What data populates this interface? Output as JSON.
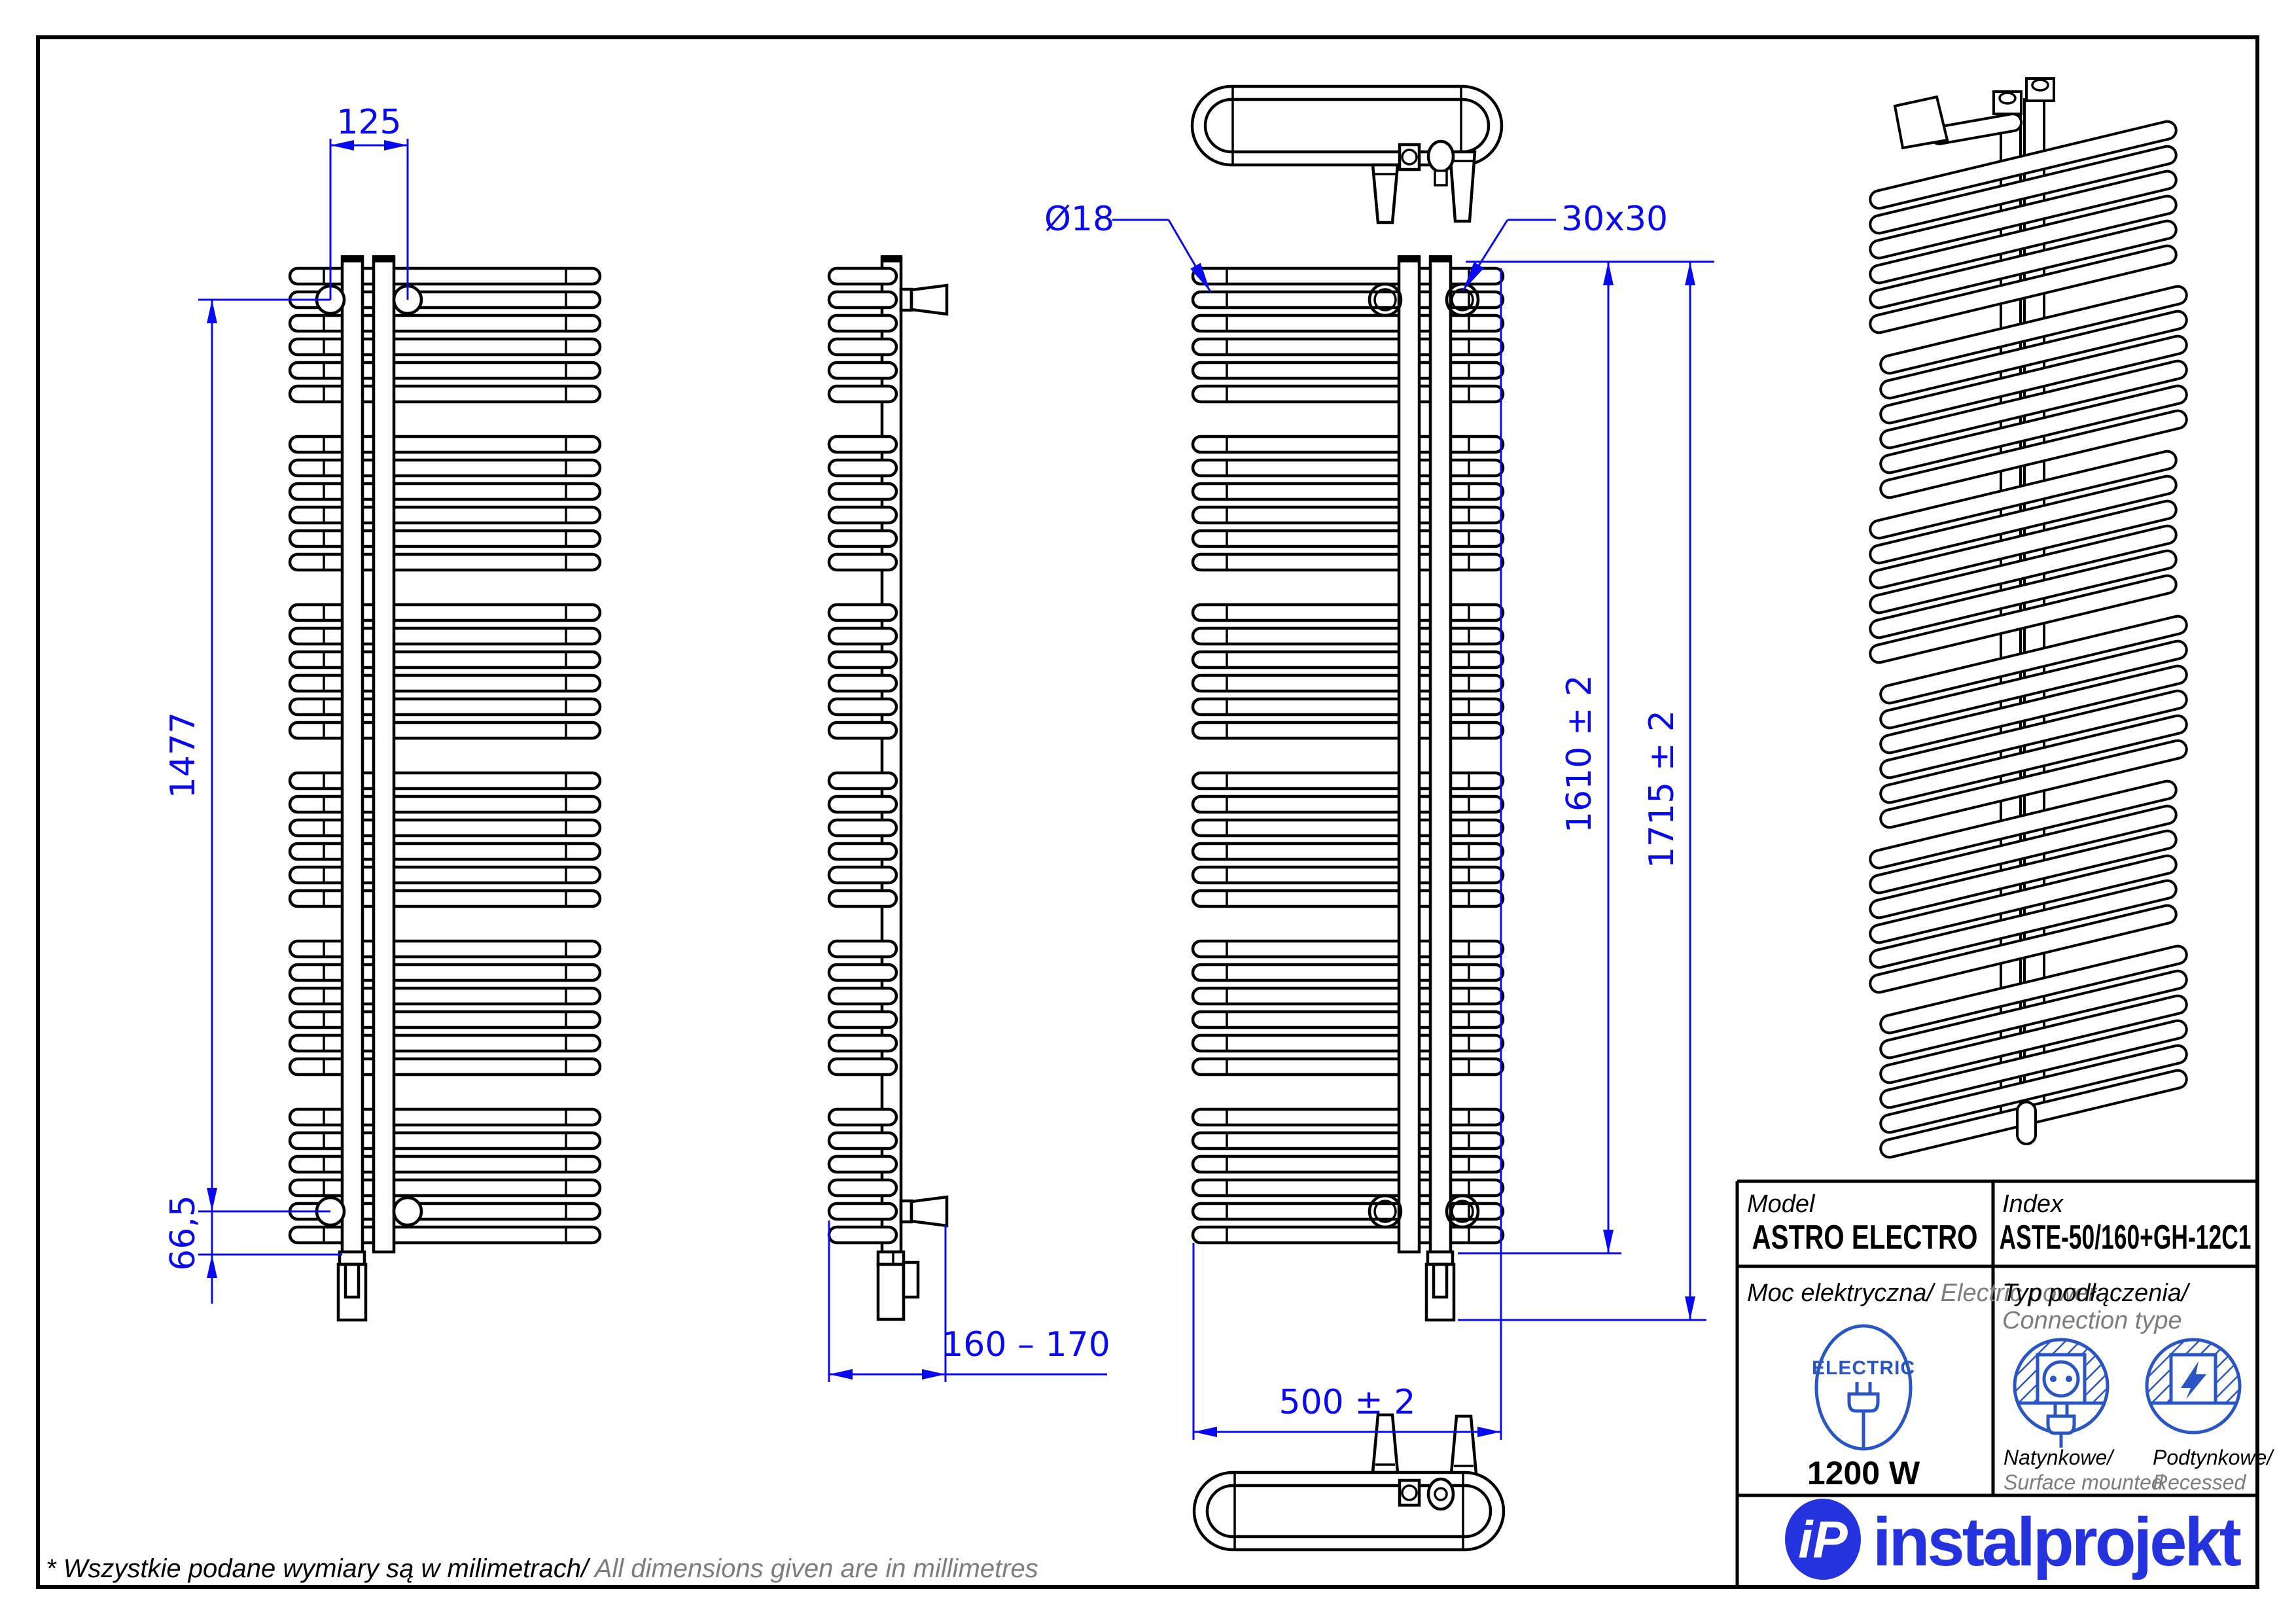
{
  "colors": {
    "dim": "#0a0af0",
    "line": "#000000",
    "icon": "#2a55c4",
    "logo": "#2533df",
    "muted": "#7d7d7d",
    "white": "#ffffff"
  },
  "dimensions": {
    "bracket_spacing": "125",
    "bracket_height": "1477",
    "bottom_offset": "66,5",
    "depth_range": "160 – 170",
    "width": "500 ± 2",
    "height_collector": "1610 ± 2",
    "height_total": "1715 ± 2",
    "tube_diameter": "Ø18",
    "collector_profile": "30x30"
  },
  "title_block": {
    "model_label": "Model",
    "model_value": "ASTRO ELECTRO",
    "index_label": "Index",
    "index_value": "ASTE-50/160+GH-12C1",
    "power_label_pl": "Moc elektryczna/",
    "power_label_en": " Electric power",
    "power_value": "1200 W",
    "connection_label_pl": "Typ podłączenia/",
    "connection_label_en": "Connection type",
    "electric_badge": "ELECTRIC",
    "surface_label_pl": "Natynkowe/",
    "surface_label_en": "Surface mounted",
    "recessed_label_pl": "Podtynkowe/",
    "recessed_label_en": "Recessed"
  },
  "logo": {
    "monogram": "iP",
    "brand": "instalprojekt"
  },
  "footer": {
    "note_pl": "* Wszystkie podane wymiary są w milimetrach/",
    "note_en": " All dimensions given are in millimetres"
  }
}
